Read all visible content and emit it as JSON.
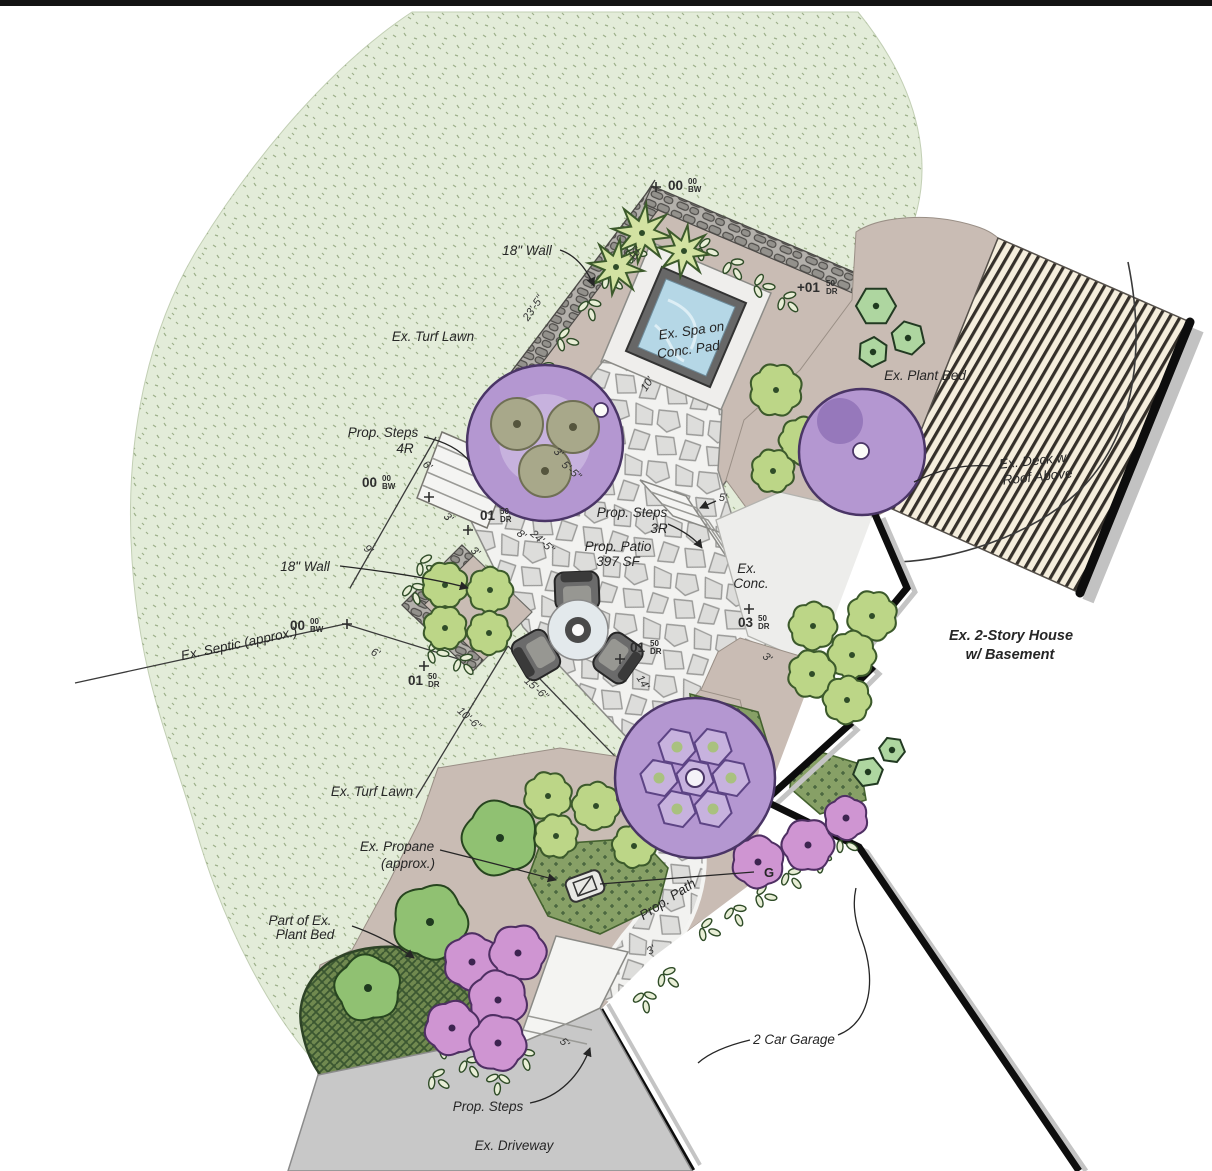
{
  "title": "Residential landscape design plan",
  "colors": {
    "turf": "#e3ecd9",
    "bed": "#c9bcb4",
    "flagstone_bg": "#f2f2f0",
    "deck": "#f5eedd",
    "water": "#b5d7e6",
    "driveway": "#c8c8c8",
    "purple_tree": "#b497d1",
    "lime_shrub": "#bcd687",
    "pink_shrub": "#cf95d2",
    "dark_bed": "#87a066",
    "house_wall": "#111111"
  },
  "plant_symbols": [
    "turf-stipple",
    "purple-canopy-tree",
    "lime-scalloped-shrub",
    "five-lobe-green-tree",
    "hexagon-shrub",
    "star-flower-shrub",
    "pink-flower-shrub",
    "vine-sprig",
    "dotted-groundcover-bed",
    "basketweave-groundcover-bed"
  ],
  "labels": [
    {
      "name": "wall-label-top",
      "text": "18\" Wall",
      "x": 527,
      "y": 255,
      "rot": 0
    },
    {
      "name": "turf-label-upper",
      "text": "Ex. Turf Lawn",
      "x": 433,
      "y": 341,
      "rot": 0
    },
    {
      "name": "spa-label-1",
      "text": "Ex. Spa on",
      "x": 692,
      "y": 335,
      "rot": -8
    },
    {
      "name": "spa-label-2",
      "text": "Conc. Pad",
      "x": 689,
      "y": 354,
      "rot": -8
    },
    {
      "name": "plant-bed-label-right",
      "text": "Ex. Plant Bed",
      "x": 925,
      "y": 380,
      "rot": 0
    },
    {
      "name": "deck-label-1",
      "text": "Ex. Deck w/",
      "x": 1035,
      "y": 465,
      "rot": -6
    },
    {
      "name": "deck-label-2",
      "text": "Roof Above",
      "x": 1038,
      "y": 481,
      "rot": -6
    },
    {
      "name": "steps4r-label-1",
      "text": "Prop. Steps",
      "x": 383,
      "y": 437,
      "rot": 0
    },
    {
      "name": "steps4r-label-2",
      "text": "4R",
      "x": 405,
      "y": 453,
      "rot": 0
    },
    {
      "name": "wall-label-left",
      "text": "18\" Wall",
      "x": 305,
      "y": 571,
      "rot": 0
    },
    {
      "name": "septic-label",
      "text": "Ex. Septic (approx.)",
      "x": 240,
      "y": 648,
      "rot": -12
    },
    {
      "name": "steps3r-label-1",
      "text": "Prop. Steps",
      "x": 632,
      "y": 517,
      "rot": 0
    },
    {
      "name": "steps3r-label-2",
      "text": "3R",
      "x": 659,
      "y": 533,
      "rot": 0
    },
    {
      "name": "patio-label-1",
      "text": "Prop. Patio",
      "x": 618,
      "y": 551,
      "rot": 0
    },
    {
      "name": "patio-label-2",
      "text": "397 SF",
      "x": 618,
      "y": 566,
      "rot": 0
    },
    {
      "name": "conc-label-1",
      "text": "Ex.",
      "x": 747,
      "y": 573,
      "rot": 0
    },
    {
      "name": "conc-label-2",
      "text": "Conc.",
      "x": 751,
      "y": 588,
      "rot": 0
    },
    {
      "name": "house-label-1",
      "text": "Ex. 2-Story House",
      "x": 1011,
      "y": 640,
      "rot": 0,
      "bold": true
    },
    {
      "name": "house-label-2",
      "text": "w/ Basement",
      "x": 1010,
      "y": 659,
      "rot": 0,
      "bold": true
    },
    {
      "name": "turf-label-lower",
      "text": "Ex. Turf Lawn",
      "x": 372,
      "y": 796,
      "rot": 0
    },
    {
      "name": "propane-label-1",
      "text": "Ex. Propane",
      "x": 397,
      "y": 851,
      "rot": 0
    },
    {
      "name": "propane-label-2",
      "text": "(approx.)",
      "x": 408,
      "y": 868,
      "rot": 0
    },
    {
      "name": "part-bed-label-1",
      "text": "Part of Ex.",
      "x": 300,
      "y": 925,
      "rot": 0
    },
    {
      "name": "part-bed-label-2",
      "text": "Plant Bed",
      "x": 305,
      "y": 939,
      "rot": 0
    },
    {
      "name": "path-label",
      "text": "Prop. Path",
      "x": 670,
      "y": 903,
      "rot": -33
    },
    {
      "name": "gas-label",
      "text": "G",
      "x": 769,
      "y": 877,
      "rot": 0,
      "gas": true
    },
    {
      "name": "garage-label",
      "text": "2 Car Garage",
      "x": 794,
      "y": 1044,
      "rot": 0
    },
    {
      "name": "steps-bottom-label",
      "text": "Prop. Steps",
      "x": 488,
      "y": 1111,
      "rot": 0
    },
    {
      "name": "driveway-label",
      "text": "Ex. Driveway",
      "x": 514,
      "y": 1150,
      "rot": 0
    },
    {
      "name": "dim-wall-top",
      "text": "23'-5\"",
      "x": 536,
      "y": 310,
      "rot": -56,
      "kind": "dim"
    },
    {
      "name": "dim-spa-side-1",
      "text": "10'",
      "x": 638,
      "y": 256,
      "rot": -56,
      "kind": "dim"
    },
    {
      "name": "dim-spa-side-2",
      "text": "10'",
      "x": 650,
      "y": 386,
      "rot": -56,
      "kind": "dim"
    },
    {
      "name": "dim-3ft-spa",
      "text": "3'",
      "x": 556,
      "y": 455,
      "rot": 42,
      "kind": "dim"
    },
    {
      "name": "dim-5ft5",
      "text": "5'-5\"",
      "x": 569,
      "y": 473,
      "rot": 42,
      "kind": "dim"
    },
    {
      "name": "dim-6ft-upper",
      "text": "6'",
      "x": 425,
      "y": 468,
      "rot": 42,
      "kind": "dim"
    },
    {
      "name": "dim-3ft-steps-1",
      "text": "3'",
      "x": 446,
      "y": 520,
      "rot": 42,
      "kind": "dim"
    },
    {
      "name": "dim-3ft-steps-2",
      "text": "3'",
      "x": 473,
      "y": 554,
      "rot": 42,
      "kind": "dim"
    },
    {
      "name": "dim-9ft",
      "text": "9'",
      "x": 366,
      "y": 552,
      "rot": 42,
      "kind": "dim"
    },
    {
      "name": "dim-8ft",
      "text": "8'",
      "x": 519,
      "y": 537,
      "rot": 42,
      "kind": "dim"
    },
    {
      "name": "dim-patio-long",
      "text": "24'-5\"",
      "x": 540,
      "y": 544,
      "rot": 42,
      "kind": "dim"
    },
    {
      "name": "dim-6ft-lower",
      "text": "6'",
      "x": 374,
      "y": 656,
      "rot": 24,
      "kind": "dim"
    },
    {
      "name": "dim-10ft6",
      "text": "10'-6\"",
      "x": 467,
      "y": 721,
      "rot": 42,
      "kind": "dim"
    },
    {
      "name": "dim-15ft6",
      "text": "15'-6\"",
      "x": 534,
      "y": 691,
      "rot": 42,
      "kind": "dim"
    },
    {
      "name": "dim-14ft",
      "text": "14'",
      "x": 640,
      "y": 684,
      "rot": 58,
      "kind": "dim"
    },
    {
      "name": "dim-5ft-steps3r",
      "text": "5'",
      "x": 723,
      "y": 501,
      "rot": 0,
      "kind": "dim"
    },
    {
      "name": "dim-3ft-bed",
      "text": "3'",
      "x": 765,
      "y": 660,
      "rot": 40,
      "kind": "dim"
    },
    {
      "name": "dim-5ft-bottom",
      "text": "5'",
      "x": 562,
      "y": 1045,
      "rot": 46,
      "kind": "dim"
    },
    {
      "name": "dim-3ft-path",
      "text": "3'",
      "x": 653,
      "y": 953,
      "rot": -33,
      "kind": "dim"
    }
  ],
  "markers": [
    {
      "name": "elev-top",
      "value": "00",
      "sup": "00",
      "sub": "BW",
      "x": 668,
      "y": 190,
      "plus": [
        656,
        187
      ]
    },
    {
      "name": "elev-upper-right",
      "value": "+01",
      "sup": "50",
      "sub": "DR",
      "x": 797,
      "y": 292
    },
    {
      "name": "elev-left-upper",
      "value": "00",
      "sup": "00",
      "sub": "BW",
      "x": 362,
      "y": 487,
      "plus": [
        429,
        497
      ]
    },
    {
      "name": "elev-steps4r",
      "value": "01",
      "sup": "50",
      "sub": "DR",
      "x": 480,
      "y": 520,
      "plus": [
        468,
        530
      ]
    },
    {
      "name": "elev-septic",
      "value": "00",
      "sup": "00",
      "sub": "BW",
      "x": 290,
      "y": 630,
      "plus": [
        347,
        624
      ]
    },
    {
      "name": "elev-lower-left",
      "value": "01",
      "sup": "50",
      "sub": "DR",
      "x": 408,
      "y": 685,
      "plus": [
        424,
        666
      ]
    },
    {
      "name": "elev-patio",
      "value": "01",
      "sup": "50",
      "sub": "DR",
      "x": 630,
      "y": 652,
      "plus": [
        620,
        659
      ]
    },
    {
      "name": "elev-conc",
      "value": "03",
      "sup": "50",
      "sub": "DR",
      "x": 738,
      "y": 627,
      "plus": [
        749,
        609
      ]
    }
  ]
}
